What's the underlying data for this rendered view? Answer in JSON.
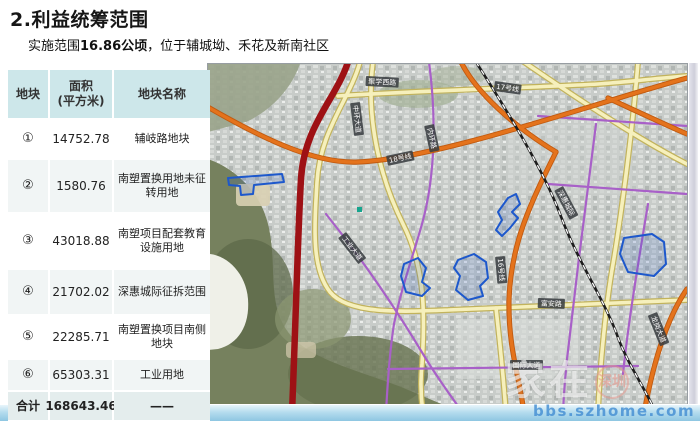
{
  "slide": {
    "title": "2.利益统筹范围",
    "subtitle_prefix": "实施范围",
    "subtitle_bold": "16.86公顷",
    "subtitle_suffix": "，位于辅城坳、禾花及新南社区"
  },
  "table": {
    "headers": {
      "plot": "地块",
      "area": "面积\n(平方米)",
      "name": "地块名称"
    },
    "rows": [
      {
        "id": "①",
        "area": "14752.78",
        "name": "辅岐路地块"
      },
      {
        "id": "②",
        "area": "1580.76",
        "name": "南塑置换用地未征转用地"
      },
      {
        "id": "③",
        "area": "43018.88",
        "name": "南塑项目配套教育设施用地"
      },
      {
        "id": "④",
        "area": "21702.02",
        "name": "深惠城际征拆范围"
      },
      {
        "id": "⑤",
        "area": "22285.71",
        "name": "南塑置换项目南侧地块"
      },
      {
        "id": "⑥",
        "area": "65303.31",
        "name": "工业用地"
      }
    ],
    "total": {
      "label": "合计",
      "area": "168643.46",
      "name": "——"
    }
  },
  "map": {
    "labels": [
      {
        "text": "聚学西路"
      },
      {
        "text": "17号线"
      },
      {
        "text": "中环大道"
      },
      {
        "text": "内环路"
      },
      {
        "text": "18号线"
      },
      {
        "text": "16号线"
      },
      {
        "text": "深惠城际"
      },
      {
        "text": "工业大道"
      },
      {
        "text": "富安路"
      },
      {
        "text": "国际大道"
      },
      {
        "text": "龙岗大道"
      }
    ],
    "colors": {
      "expressway_red": "#9e1115",
      "metro_orange": "#e4731c",
      "road_yellow": "#f6f0bc",
      "road_purple": "#a860c8",
      "railway_black": "#1d1d1d",
      "plot_outline_blue": "#1d58cc",
      "header_teal": "#cde7ea"
    }
  },
  "watermark": {
    "brand_main": "家在",
    "brand_badge": "深圳",
    "site": "bbs.szhome.com"
  }
}
